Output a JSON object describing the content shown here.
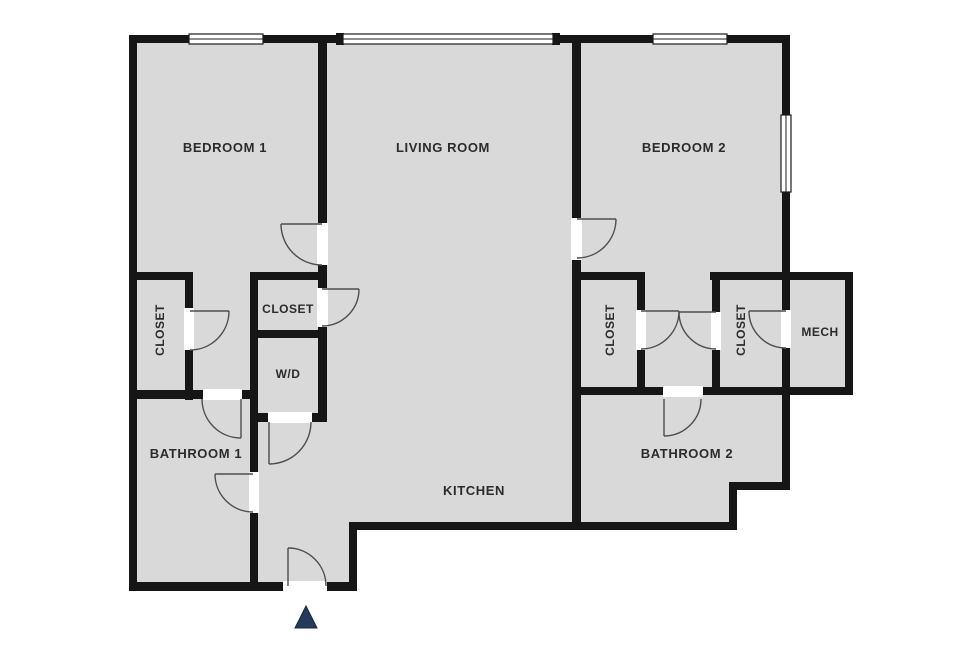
{
  "plan": {
    "title": "Two-bedroom apartment floor plan"
  },
  "rooms": {
    "bedroom_1": {
      "label": "BEDROOM 1"
    },
    "living_room": {
      "label": "LIVING ROOM"
    },
    "bedroom_2": {
      "label": "BEDROOM 2"
    },
    "closet_left": {
      "label": "CLOSET"
    },
    "closet_center": {
      "label": "CLOSET"
    },
    "washer_dryer": {
      "label": "W/D"
    },
    "bathroom_1": {
      "label": "BATHROOM 1"
    },
    "kitchen": {
      "label": "KITCHEN"
    },
    "bathroom_2": {
      "label": "BATHROOM 2"
    },
    "closet_right_1": {
      "label": "CLOSET"
    },
    "closet_right_2": {
      "label": "CLOSET"
    },
    "mech": {
      "label": "MECH"
    }
  },
  "colors": {
    "background": "#ffffff",
    "floor": "#d9d9d9",
    "wall": "#161616",
    "door_line": "#4d4d4d",
    "text": "#2b2b2b",
    "entrance_marker": "#24395c"
  },
  "icons": {
    "entrance_marker": "triangle-up"
  }
}
